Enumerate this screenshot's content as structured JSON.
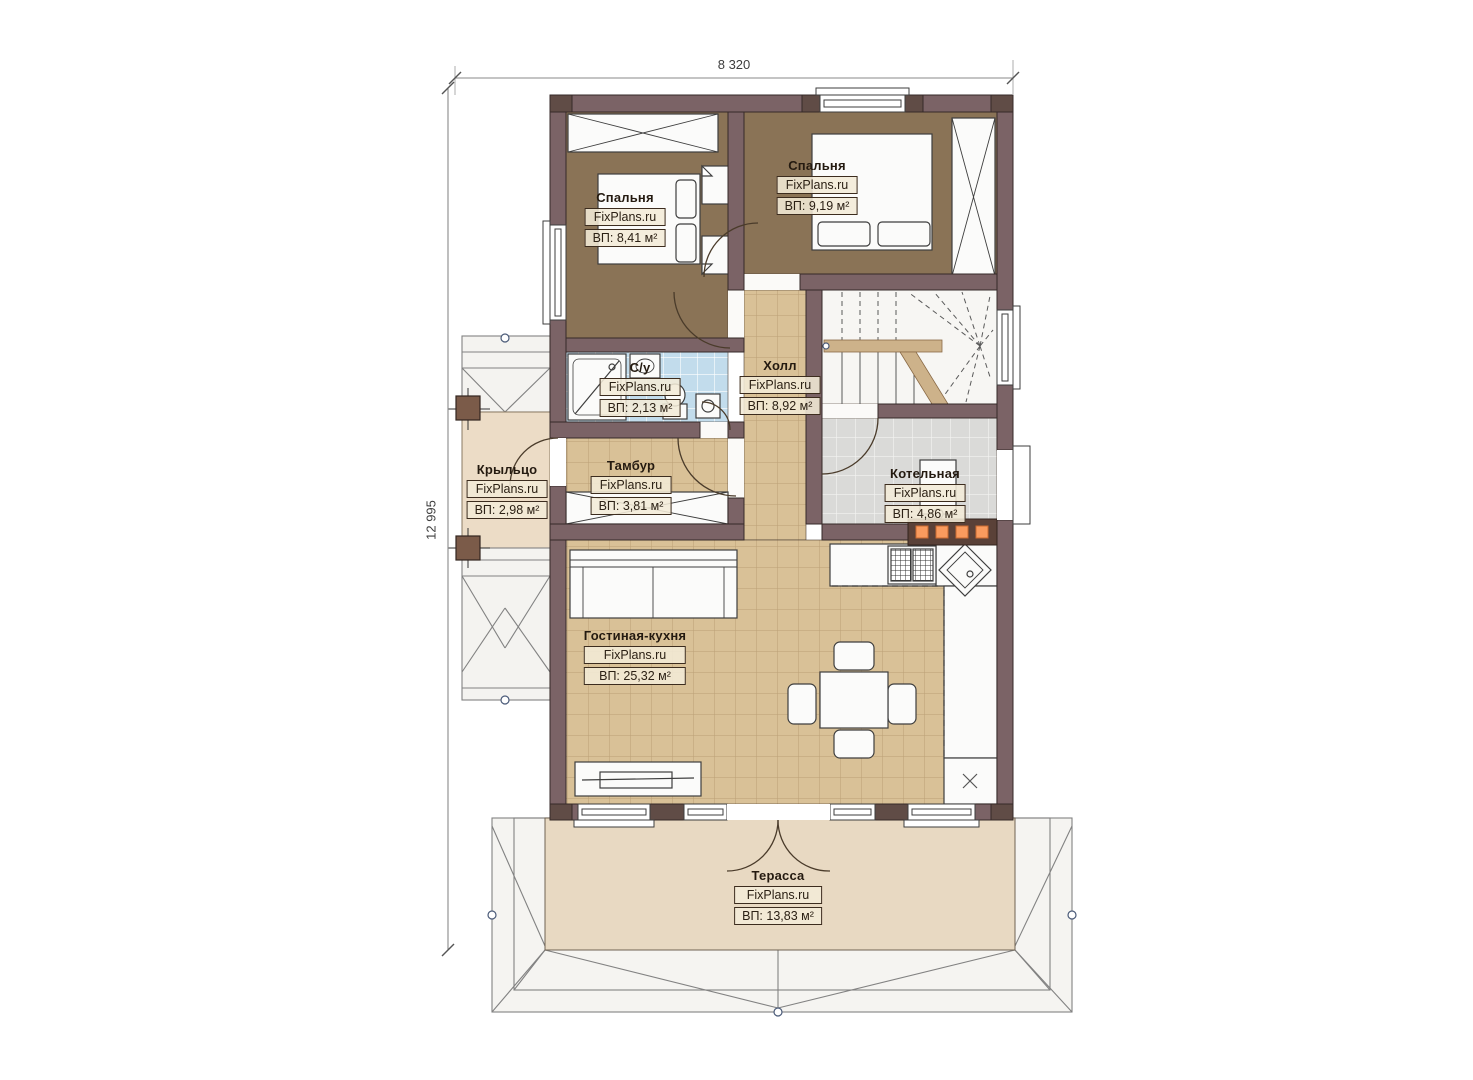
{
  "plan": {
    "dimensions": {
      "width": "8 320",
      "height": "12 995"
    },
    "brand": "FixPlans.ru",
    "rooms": [
      {
        "id": "bedroom-1",
        "name": "Спальня",
        "brand": "FixPlans.ru",
        "area": "ВП: 8,41 м²"
      },
      {
        "id": "bedroom-2",
        "name": "Спальня",
        "brand": "FixPlans.ru",
        "area": "ВП: 9,19 м²"
      },
      {
        "id": "bathroom",
        "name": "С/у",
        "brand": "FixPlans.ru",
        "area": "ВП: 2,13 м²"
      },
      {
        "id": "hall",
        "name": "Холл",
        "brand": "FixPlans.ru",
        "area": "ВП: 8,92 м²"
      },
      {
        "id": "porch",
        "name": "Крыльцо",
        "brand": "FixPlans.ru",
        "area": "ВП: 2,98 м²"
      },
      {
        "id": "vestibule",
        "name": "Тамбур",
        "brand": "FixPlans.ru",
        "area": "ВП: 3,81 м²"
      },
      {
        "id": "boiler-room",
        "name": "Котельная",
        "brand": "FixPlans.ru",
        "area": "ВП: 4,86 м²"
      },
      {
        "id": "living-kitchen",
        "name": "Гостиная-кухня",
        "brand": "FixPlans.ru",
        "area": "ВП: 25,32 м²"
      },
      {
        "id": "terrace",
        "name": "Терасса",
        "brand": "FixPlans.ru",
        "area": "ВП: 13,83 м²"
      }
    ],
    "colors": {
      "wall": "#7b6366",
      "wall_dark": "#604c46",
      "bedroom_floor": "#8a7356",
      "tile_tan": "#d9c197",
      "tile_blue": "#c2dcec",
      "tile_gray": "#dadad8",
      "terrace": "#e8d9c2",
      "accent_orange": "#f99b5e"
    }
  }
}
